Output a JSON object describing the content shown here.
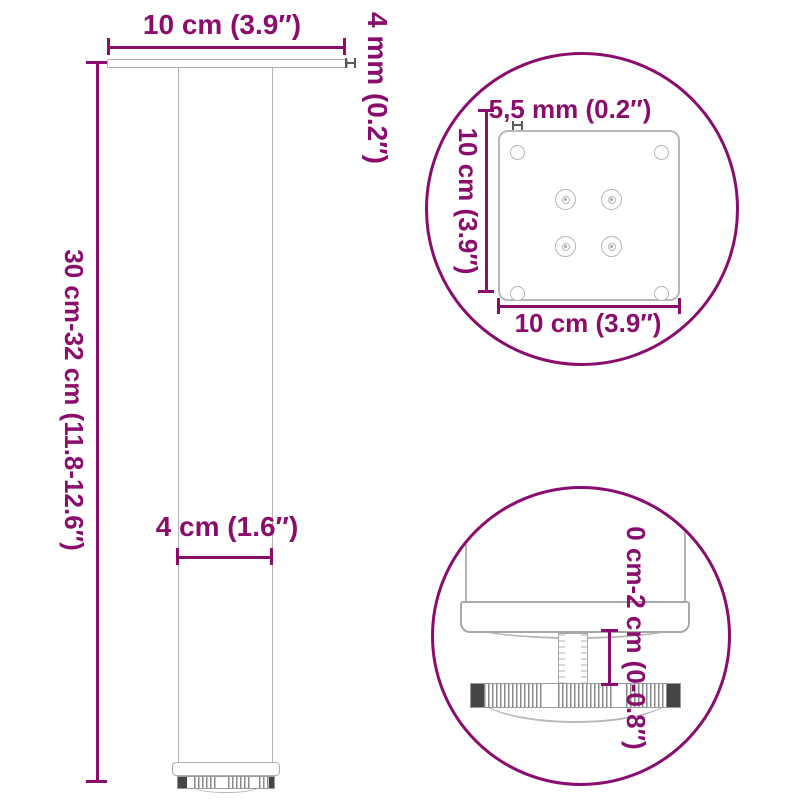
{
  "colors": {
    "accent": "#8A0D6E",
    "line_gray": "#ADADAD",
    "dark_gray": "#454545"
  },
  "front_view": {
    "width_label": "10 cm (3.9″)",
    "thickness_label": "4 mm (0.2″)",
    "height_label": "30 cm-32 cm (11.8-12.6″)",
    "diameter_label": "4 cm (1.6″)"
  },
  "plate_detail": {
    "hole_label": "5,5 mm (0.2″)",
    "height_label": "10 cm (3.9″)",
    "width_label": "10 cm (3.9″)"
  },
  "foot_detail": {
    "range_label": "0 cm-2 cm (0-0.8″)"
  }
}
